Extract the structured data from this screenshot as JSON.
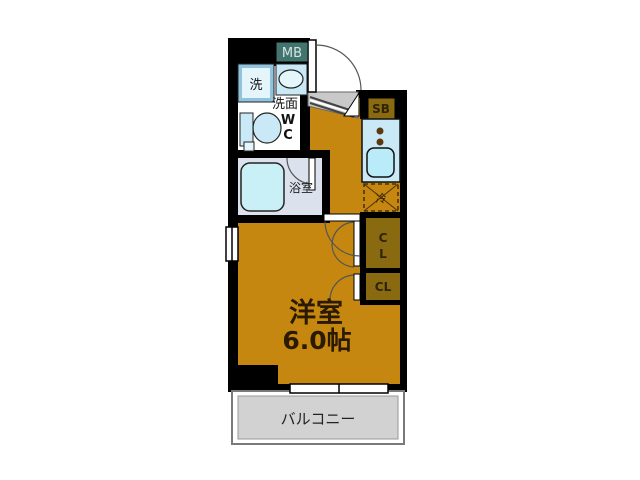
{
  "plan": {
    "type": "japanese-apartment-floorplan",
    "labels": {
      "meter_box": "MB",
      "shoe_box": "SB",
      "washer": "洗",
      "vanity": "洗面",
      "wc_line1": "W",
      "wc_line2": "C",
      "bathroom": "浴室",
      "fridge": "冷",
      "closet_top_line1": "C",
      "closet_top_line2": "L",
      "closet_bottom": "CL",
      "room_name": "洋室",
      "room_size": "6.0帖",
      "balcony": "バルコニー"
    },
    "colors": {
      "wall": "#000000",
      "floor": "#c5870f",
      "bath_floor": "#dbe1ed",
      "tub": "#c9f0f6",
      "fixture_blue": "#c9e9f6",
      "fixture_pale": "#e4f5fc",
      "sink_bowl": "#b9ecf8",
      "meter_box_bg": "#41756e",
      "meter_box_text": "#d7e5e2",
      "storage_bg": "#8a6a10",
      "storage_text": "#2f2405",
      "genkan": "#c9c9c9",
      "balcony_fill": "#d2d2d2",
      "balcony_edge": "#7a7a7a",
      "room_text": "#2a1a00",
      "door_arc": "#555555",
      "burner_dot": "#5c3a10"
    }
  }
}
